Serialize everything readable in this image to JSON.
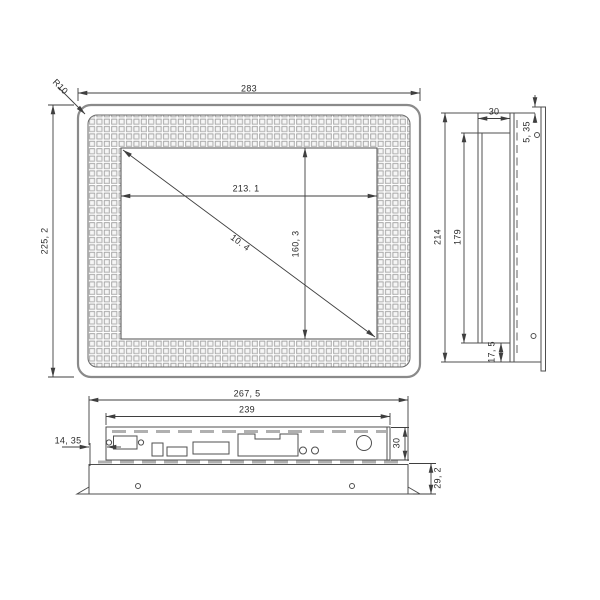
{
  "drawing": {
    "title": "panel-monitor-dimension-drawing",
    "front_view": {
      "overall_width": "283",
      "overall_height": "225, 2",
      "display_width": "213. 1",
      "display_height": "160, 3",
      "display_diagonal": "10. 4",
      "corner_radius": "R10"
    },
    "side_view": {
      "chassis_depth": "30",
      "chassis_height": "214",
      "inner_height": "179",
      "hole_offset": "5, 35",
      "bottom_step": "17, 5"
    },
    "bottom_view": {
      "bezel_width": "267, 5",
      "chassis_width": "239",
      "left_offset": "14, 35",
      "chassis_depth": "30",
      "bezel_depth": "29, 2"
    }
  }
}
